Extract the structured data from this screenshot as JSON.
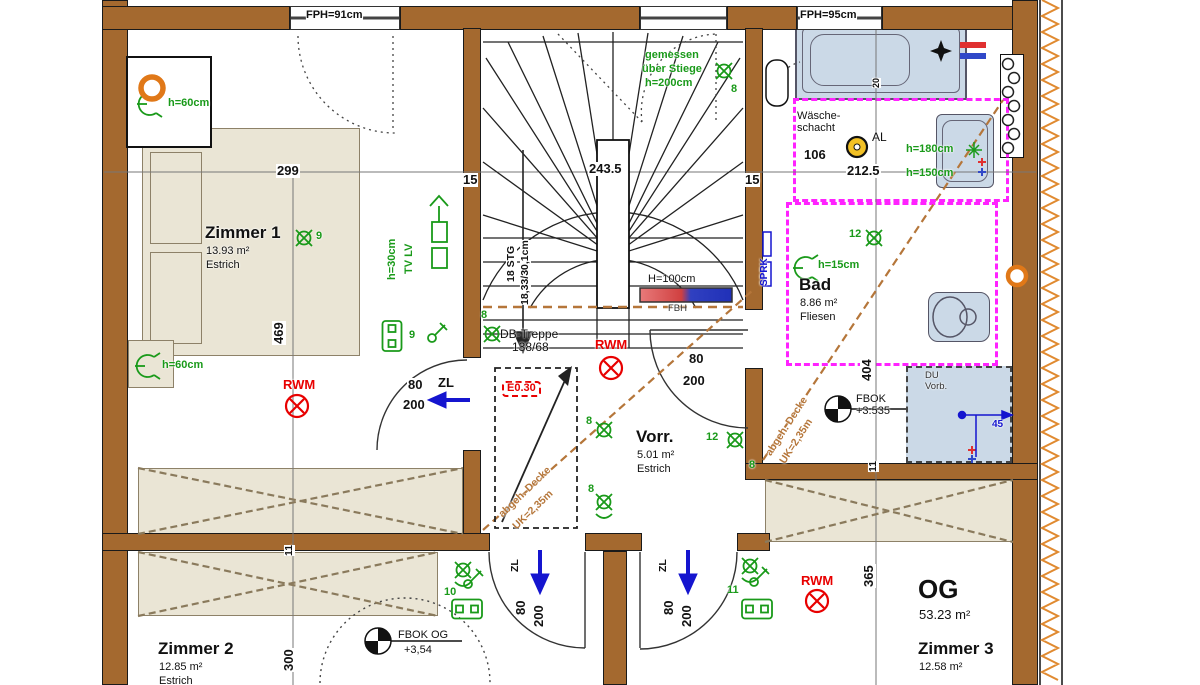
{
  "meta": {
    "drawing_type": "architectural floor plan",
    "floor_shown": "OG (Obergeschoss / upper floor)"
  },
  "colors": {
    "wall_brown": "#A4692F",
    "furniture_beige": "#EAE5D5",
    "sanitary_blue": "#CBD9E7",
    "magenta_dashed": "#FF22FF",
    "electric_green": "#1A9A1A",
    "alarm_red": "#E80000",
    "vent_blue": "#1515CF",
    "ceiling_brown_dashed": "#B5763A",
    "insulation_orange": "#E08A30",
    "al_yellow": "#F2C126"
  },
  "texts": [
    {
      "n": "room-zimmer1-name",
      "t": "Zimmer 1",
      "x": 205,
      "y": 224,
      "c": "room"
    },
    {
      "n": "room-zimmer1-area",
      "t": "13.93 m²",
      "x": 206,
      "y": 246,
      "c": "sub"
    },
    {
      "n": "room-zimmer1-floor",
      "t": "Estrich",
      "x": 206,
      "y": 260,
      "c": "sub"
    },
    {
      "n": "room-vorraum-name",
      "t": "Vorr.",
      "x": 636,
      "y": 428,
      "c": "room"
    },
    {
      "n": "room-vorraum-area",
      "t": "5.01 m²",
      "x": 637,
      "y": 450,
      "c": "sub"
    },
    {
      "n": "room-vorraum-floor",
      "t": "Estrich",
      "x": 637,
      "y": 464,
      "c": "sub"
    },
    {
      "n": "room-bad-name",
      "t": "Bad",
      "x": 799,
      "y": 276,
      "c": "room"
    },
    {
      "n": "room-bad-area",
      "t": "8.86 m²",
      "x": 800,
      "y": 298,
      "c": "sub"
    },
    {
      "n": "room-bad-floor",
      "t": "Fliesen",
      "x": 800,
      "y": 312,
      "c": "sub"
    },
    {
      "n": "room-zimmer2-name",
      "t": "Zimmer 2",
      "x": 158,
      "y": 640,
      "c": "room"
    },
    {
      "n": "room-zimmer2-area",
      "t": "12.85 m²",
      "x": 159,
      "y": 662,
      "c": "sub"
    },
    {
      "n": "room-zimmer2-floor",
      "t": "Estrich",
      "x": 159,
      "y": 676,
      "c": "sub"
    },
    {
      "n": "room-zimmer3-name",
      "t": "Zimmer 3",
      "x": 918,
      "y": 640,
      "c": "room"
    },
    {
      "n": "room-zimmer3-area",
      "t": "12.58 m²",
      "x": 919,
      "y": 662,
      "c": "sub"
    },
    {
      "n": "floor-og-name",
      "t": "OG",
      "x": 918,
      "y": 576,
      "c": "og"
    },
    {
      "n": "floor-og-area",
      "t": "53.23 m²",
      "x": 919,
      "y": 608,
      "c": "sub13"
    },
    {
      "n": "window-fph-left",
      "t": "FPH=91cm",
      "x": 306,
      "y": 10,
      "c": "dim11"
    },
    {
      "n": "window-fph-right",
      "t": "FPH=95cm",
      "x": 800,
      "y": 10,
      "c": "dim11"
    },
    {
      "n": "dim-299",
      "t": "299",
      "x": 276,
      "y": 164,
      "c": "dim"
    },
    {
      "n": "dim-15-left",
      "t": "15",
      "x": 462,
      "y": 173,
      "c": "dim"
    },
    {
      "n": "dim-243-5",
      "t": "243.5",
      "x": 588,
      "y": 162,
      "c": "dim"
    },
    {
      "n": "dim-15-right",
      "t": "15",
      "x": 744,
      "y": 173,
      "c": "dim"
    },
    {
      "n": "dim-106",
      "t": "106",
      "x": 803,
      "y": 148,
      "c": "dim"
    },
    {
      "n": "dim-212-5",
      "t": "212.5",
      "x": 846,
      "y": 164,
      "c": "dim"
    },
    {
      "n": "dim-469",
      "t": "469",
      "x": 272,
      "y": 345,
      "c": "dim",
      "r": -90
    },
    {
      "n": "dim-404",
      "t": "404",
      "x": 860,
      "y": 382,
      "c": "dim",
      "r": -90
    },
    {
      "n": "dim-11-left",
      "t": "11",
      "x": 284,
      "y": 556,
      "c": "dim10",
      "r": -90
    },
    {
      "n": "dim-11-right",
      "t": "11",
      "x": 868,
      "y": 472,
      "c": "dim10",
      "r": -90
    },
    {
      "n": "dim-365",
      "t": "365",
      "x": 862,
      "y": 588,
      "c": "dim",
      "r": -90
    },
    {
      "n": "dim-300",
      "t": "300",
      "x": 282,
      "y": 672,
      "c": "dim",
      "r": -90
    },
    {
      "n": "dim-20-bathtub",
      "t": "20",
      "x": 872,
      "y": 88,
      "c": "dim9",
      "r": -90
    },
    {
      "n": "stair-step-count",
      "t": "18 STG",
      "x": 506,
      "y": 282,
      "c": "dim10",
      "r": -90
    },
    {
      "n": "stair-step-size",
      "t": "18,33/30,1cm",
      "x": 520,
      "y": 305,
      "c": "dim10",
      "r": -90
    },
    {
      "n": "stair-note-measured",
      "t": "gemessen",
      "x": 645,
      "y": 50,
      "c": "green"
    },
    {
      "n": "stair-note-over",
      "t": "über Stiege",
      "x": 642,
      "y": 64,
      "c": "green"
    },
    {
      "n": "stair-note-height",
      "t": "h=200cm",
      "x": 645,
      "y": 78,
      "c": "green"
    },
    {
      "n": "lamp-8-stair",
      "t": "8",
      "x": 731,
      "y": 84,
      "c": "green"
    },
    {
      "n": "attic-stair-label",
      "t": "DB-Treppe",
      "x": 500,
      "y": 328,
      "c": "black12"
    },
    {
      "n": "attic-stair-size",
      "t": "138/68",
      "x": 512,
      "y": 341,
      "c": "black12"
    },
    {
      "n": "escape-hatch-label",
      "t": "E0.30",
      "x": 502,
      "y": 381,
      "c": "e030"
    },
    {
      "n": "rwm-zimmer1",
      "t": "RWM",
      "x": 283,
      "y": 378,
      "c": "red"
    },
    {
      "n": "rwm-vorraum",
      "t": "RWM",
      "x": 595,
      "y": 338,
      "c": "red"
    },
    {
      "n": "rwm-zimmer3",
      "t": "RWM",
      "x": 801,
      "y": 574,
      "c": "red"
    },
    {
      "n": "door-z1-width",
      "t": "80",
      "x": 407,
      "y": 378,
      "c": "dim"
    },
    {
      "n": "door-z1-zl",
      "t": "ZL",
      "x": 437,
      "y": 376,
      "c": "dim"
    },
    {
      "n": "door-z1-height",
      "t": "200",
      "x": 402,
      "y": 398,
      "c": "dim"
    },
    {
      "n": "door-bad-width",
      "t": "80",
      "x": 688,
      "y": 352,
      "c": "dim"
    },
    {
      "n": "door-bad-height",
      "t": "200",
      "x": 682,
      "y": 374,
      "c": "dim"
    },
    {
      "n": "door-b1-zl",
      "t": "ZL",
      "x": 510,
      "y": 572,
      "c": "dim10",
      "r": -90
    },
    {
      "n": "door-b1-width",
      "t": "80",
      "x": 514,
      "y": 616,
      "c": "dim",
      "r": -90
    },
    {
      "n": "door-b1-height",
      "t": "200",
      "x": 532,
      "y": 628,
      "c": "dim",
      "r": -90
    },
    {
      "n": "door-b2-zl",
      "t": "ZL",
      "x": 658,
      "y": 572,
      "c": "dim10",
      "r": -90
    },
    {
      "n": "door-b2-width",
      "t": "80",
      "x": 662,
      "y": 616,
      "c": "dim",
      "r": -90
    },
    {
      "n": "door-b2-height",
      "t": "200",
      "x": 680,
      "y": 628,
      "c": "dim",
      "r": -90
    },
    {
      "n": "laundry-chute-1",
      "t": "Wäsche-",
      "x": 797,
      "y": 111,
      "c": "black11"
    },
    {
      "n": "laundry-chute-2",
      "t": "schacht",
      "x": 797,
      "y": 123,
      "c": "black11"
    },
    {
      "n": "al-label",
      "t": "AL",
      "x": 872,
      "y": 131,
      "c": "black12"
    },
    {
      "n": "shower-prep-1",
      "t": "DU",
      "x": 925,
      "y": 371,
      "c": "black10"
    },
    {
      "n": "shower-prep-2",
      "t": "Vorb.",
      "x": 925,
      "y": 382,
      "c": "black10"
    },
    {
      "n": "fbok-bad-label",
      "t": "FBOK",
      "x": 856,
      "y": 394,
      "c": "black11"
    },
    {
      "n": "fbok-bad-value",
      "t": "+3.535",
      "x": 856,
      "y": 406,
      "c": "black11"
    },
    {
      "n": "fbok-og-label",
      "t": "FBOK OG",
      "x": 398,
      "y": 630,
      "c": "black11"
    },
    {
      "n": "fbok-og-value",
      "t": "+3,54",
      "x": 404,
      "y": 645,
      "c": "black11"
    },
    {
      "n": "radiator-height",
      "t": "H=100cm",
      "x": 648,
      "y": 274,
      "c": "black11"
    },
    {
      "n": "radiator-type",
      "t": "FBH",
      "x": 668,
      "y": 304,
      "c": "black10"
    },
    {
      "n": "sprinkler-label",
      "t": "SPRK",
      "x": 760,
      "y": 286,
      "c": "blue10",
      "r": -90
    },
    {
      "n": "du-dim-45",
      "t": "45",
      "x": 992,
      "y": 420,
      "c": "blue10"
    },
    {
      "n": "wall-lamp-h60-top",
      "t": "h=60cm",
      "x": 168,
      "y": 98,
      "c": "green"
    },
    {
      "n": "wall-lamp-h60-bottom",
      "t": "h=60cm",
      "x": 162,
      "y": 360,
      "c": "green"
    },
    {
      "n": "tv-height",
      "t": "h=30cm",
      "x": 387,
      "y": 280,
      "c": "green",
      "r": -90
    },
    {
      "n": "tv-lv-label",
      "t": "TV LV",
      "x": 404,
      "y": 274,
      "c": "green",
      "r": -90
    },
    {
      "n": "lamp-9-zimmer1",
      "t": "9",
      "x": 316,
      "y": 231,
      "c": "green"
    },
    {
      "n": "switch-9-label",
      "t": "9",
      "x": 409,
      "y": 330,
      "c": "green"
    },
    {
      "n": "lamp-8-vorr-left",
      "t": "8",
      "x": 481,
      "y": 310,
      "c": "green"
    },
    {
      "n": "lamp-8-vorr-mid",
      "t": "8",
      "x": 586,
      "y": 416,
      "c": "green"
    },
    {
      "n": "lamp-8-vorr-low",
      "t": "8",
      "x": 588,
      "y": 484,
      "c": "green"
    },
    {
      "n": "lamp-12-vorr",
      "t": "12",
      "x": 706,
      "y": 432,
      "c": "green"
    },
    {
      "n": "lamp-8-vorr-right",
      "t": "8",
      "x": 749,
      "y": 460,
      "c": "green"
    },
    {
      "n": "lamp-12-bad",
      "t": "12",
      "x": 849,
      "y": 229,
      "c": "green"
    },
    {
      "n": "wall-lamp-h15",
      "t": "h=15cm",
      "x": 818,
      "y": 260,
      "c": "green"
    },
    {
      "n": "basin-h180",
      "t": "h=180cm",
      "x": 906,
      "y": 144,
      "c": "green"
    },
    {
      "n": "basin-h150",
      "t": "h=150cm",
      "x": 906,
      "y": 168,
      "c": "green"
    },
    {
      "n": "switch-10-label",
      "t": "10",
      "x": 444,
      "y": 587,
      "c": "green"
    },
    {
      "n": "switch-11-label",
      "t": "11",
      "x": 727,
      "y": 585,
      "c": "green"
    },
    {
      "n": "ceiling-note1-a",
      "t": "abgeh. Decke",
      "x": 497,
      "y": 512,
      "c": "brown",
      "r": -44
    },
    {
      "n": "ceiling-note1-b",
      "t": "UK=2,35m",
      "x": 511,
      "y": 524,
      "c": "brown",
      "r": -44
    },
    {
      "n": "ceiling-note2-a",
      "t": "abgeh. Decke",
      "x": 764,
      "y": 452,
      "c": "brown",
      "r": -57
    },
    {
      "n": "ceiling-note2-b",
      "t": "UK=2,35m",
      "x": 778,
      "y": 460,
      "c": "brown",
      "r": -57
    }
  ]
}
